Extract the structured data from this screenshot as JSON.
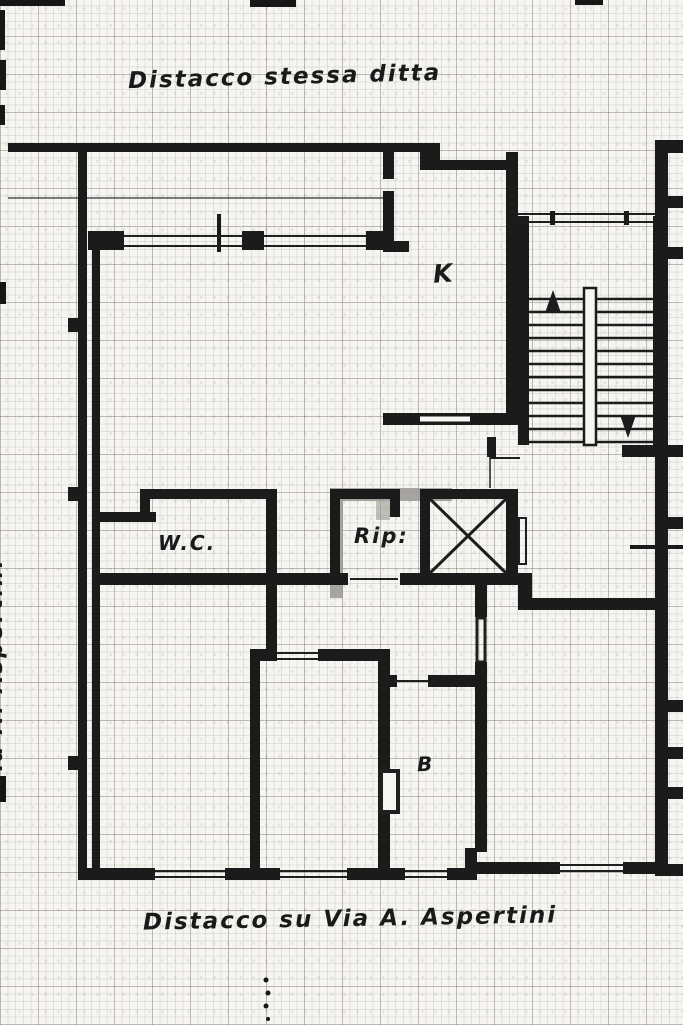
{
  "document": {
    "kind": "scanned floor plan (planimetria)",
    "width_px": 683,
    "height_px": 1025
  },
  "captions": {
    "top": "Distacco stessa ditta",
    "bottom": "Distacco su Via A. Aspertini",
    "left_vertical": "Via A. Aspertini"
  },
  "rooms": [
    {
      "id": "kitchen",
      "label": "K"
    },
    {
      "id": "wc",
      "label": "W.C."
    },
    {
      "id": "storage",
      "label": "Rip:"
    },
    {
      "id": "bathroom",
      "label": "B"
    }
  ],
  "symbols": {
    "stairs": "double-run staircase with up and down arrows",
    "elevator": "crossed-box elevator shaft"
  },
  "colors": {
    "paper": "#f6f5f1",
    "ink": "#1b1b1b",
    "grid": "#6e6a62",
    "watermark": "#9a9892"
  }
}
